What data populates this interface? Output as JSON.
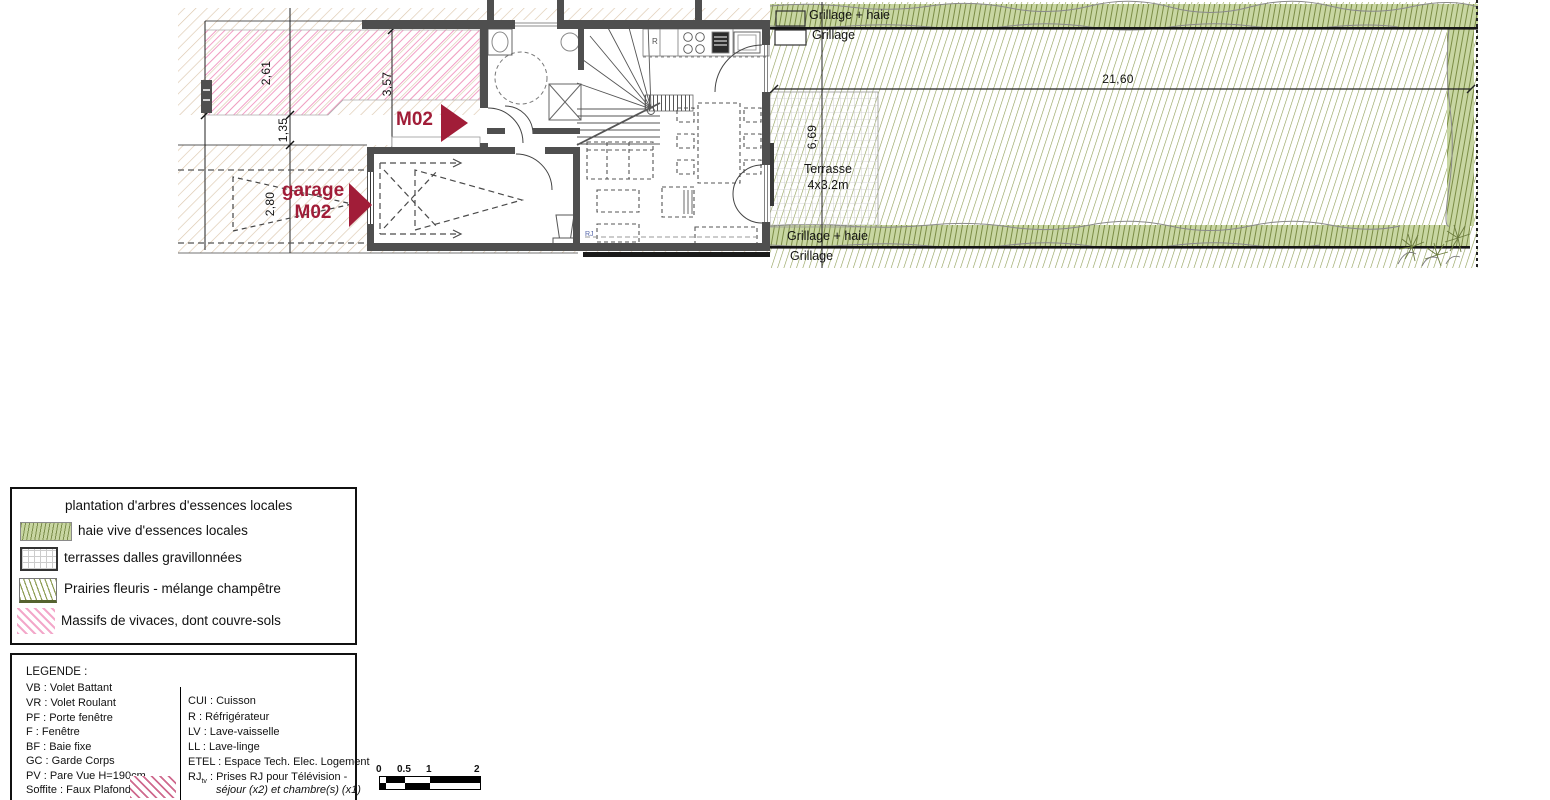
{
  "plan": {
    "unit_label": "M02",
    "garage_label_line1": "garage",
    "garage_label_line2": "M02",
    "terrasse_label_line1": "Terrasse",
    "terrasse_label_line2": "4x3.2m",
    "fence_top_label1": "Grillage + haie",
    "fence_top_label2": "Grillage",
    "fence_bottom_label1": "Grillage + haie",
    "fence_bottom_label2": "Grillage",
    "fridge_label": "R",
    "rj_socket_label": "RJ",
    "dimensions": {
      "massif_width": "2,61",
      "front_strip": "1,35",
      "entry_width": "3,57",
      "driveway_width": "2,80",
      "garden_depth": "6,69",
      "garden_length": "21,60"
    }
  },
  "legend_planting": {
    "items": [
      {
        "swatch": "tree-planting",
        "label": "plantation d'arbres d'essences locales"
      },
      {
        "swatch": "hedge",
        "label": "haie vive d'essences locales"
      },
      {
        "swatch": "gravel-grid",
        "label": "terrasses dalles gravillonnées"
      },
      {
        "swatch": "meadow-hatch",
        "label": "Prairies fleuris - mélange champêtre"
      },
      {
        "swatch": "pink-hatch",
        "label": "Massifs de vivaces, dont couvre-sols"
      }
    ]
  },
  "legend_abbreviations": {
    "title": "LEGENDE :",
    "left_column": [
      "VB : Volet Battant",
      "VR : Volet Roulant",
      "PF : Porte fenêtre",
      "F   : Fenêtre",
      "BF : Baie fixe",
      "GC : Garde Corps",
      "PV : Pare Vue H=190cm",
      "Soffite : Faux Plafond"
    ],
    "right_column": [
      "CUI   : Cuisson",
      "R    : Réfrigérateur",
      "LV : Lave-vaisselle",
      "LL : Lave-linge",
      "ETEL : Espace Tech. Elec. Logement"
    ],
    "rj_abbr": "RJ",
    "rj_sub": "tv",
    "rj_text": ": Prises RJ pour Télévision -",
    "rj_text2": "séjour (x2) et chambre(s) (x1)"
  },
  "scalebar": {
    "ticks": [
      "0",
      "0.5",
      "1",
      "2"
    ]
  },
  "colors": {
    "accent_burgundy": "#a11d38",
    "massif_pink": "#f195c1",
    "meadow_green": "#8e9d54",
    "hedge_green": "#c8d6a2",
    "front_beige": "#dcc7ae",
    "wall_gray": "#4f4f4f"
  }
}
